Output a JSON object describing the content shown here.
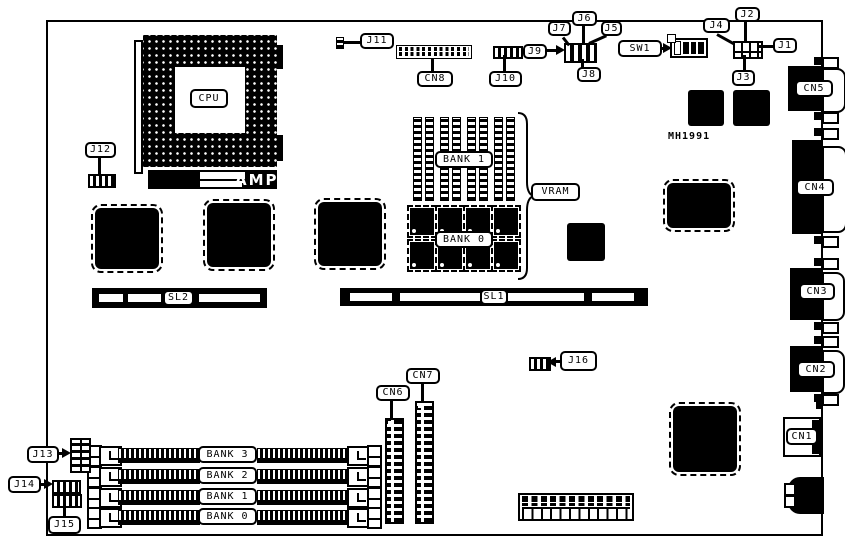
{
  "diagram_title": "motherboard component location diagram",
  "texts": {
    "cpu": "CPU",
    "amp": "AMP",
    "mh1991": "MH1991"
  },
  "labels": {
    "j1": "J1",
    "j2": "J2",
    "j3": "J3",
    "j4": "J4",
    "j5": "J5",
    "j6": "J6",
    "j7": "J7",
    "j8": "J8",
    "j9": "J9",
    "j10": "J10",
    "j11": "J11",
    "j12": "J12",
    "j13": "J13",
    "j14": "J14",
    "j15": "J15",
    "j16": "J16",
    "sw1": "SW1",
    "cn1": "CN1",
    "cn2": "CN2",
    "cn3": "CN3",
    "cn4": "CN4",
    "cn5": "CN5",
    "cn6": "CN6",
    "cn7": "CN7",
    "cn8": "CN8",
    "sl1": "SL1",
    "sl2": "SL2",
    "vram": "VRAM",
    "vram_bank1": "BANK 1",
    "vram_bank0": "BANK 0"
  },
  "simm_banks": [
    {
      "label": "BANK 3"
    },
    {
      "label": "BANK 2"
    },
    {
      "label": "BANK 1"
    },
    {
      "label": "BANK 0"
    }
  ],
  "colors": {
    "ink": "#000000",
    "paper": "#ffffff"
  }
}
